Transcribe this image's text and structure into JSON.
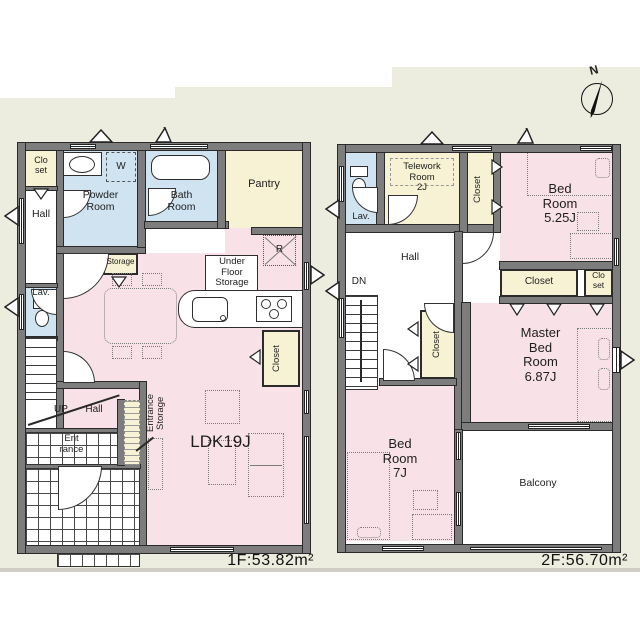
{
  "colors": {
    "paper": "#ededdf",
    "wall": "#7d7d7d",
    "pink": "#f8e2e7",
    "blue": "#cfe3f1",
    "yellow": "#f7f2d3"
  },
  "compass": {
    "north_label": "N"
  },
  "floor1": {
    "area_label": "1F:53.82m²",
    "rooms": {
      "closet_nw": "Clo\nset",
      "powder": "Powder\nRoom",
      "washer": "W",
      "bath": "Bath\nRoom",
      "pantry": "Pantry",
      "hall": "Hall",
      "storage": "Storage",
      "lav": "Lav.",
      "under_floor": "Under\nFloor\nStorage",
      "fridge": "R",
      "closet_east": "Closet",
      "up": "UP",
      "hall_lower": "Hall",
      "entrance_storage": "Entrance\nStorage",
      "entrance": "Ent\nrance",
      "ldk": "LDK19J"
    }
  },
  "floor2": {
    "area_label": "2F:56.70m²",
    "rooms": {
      "lav": "Lav.",
      "telework": "Telework\nRoom\n2J",
      "closet_north": "Closet",
      "bedroom_5": "Bed\nRoom\n5.25J",
      "hall": "Hall",
      "down": "DN",
      "closet_master_w": "Closet",
      "closet_master_n": "Closet",
      "closet_master_ne": "Clo\nset",
      "master": "Master\nBed\nRoom\n6.87J",
      "bedroom_7": "Bed\nRoom\n7J",
      "balcony": "Balcony"
    }
  }
}
